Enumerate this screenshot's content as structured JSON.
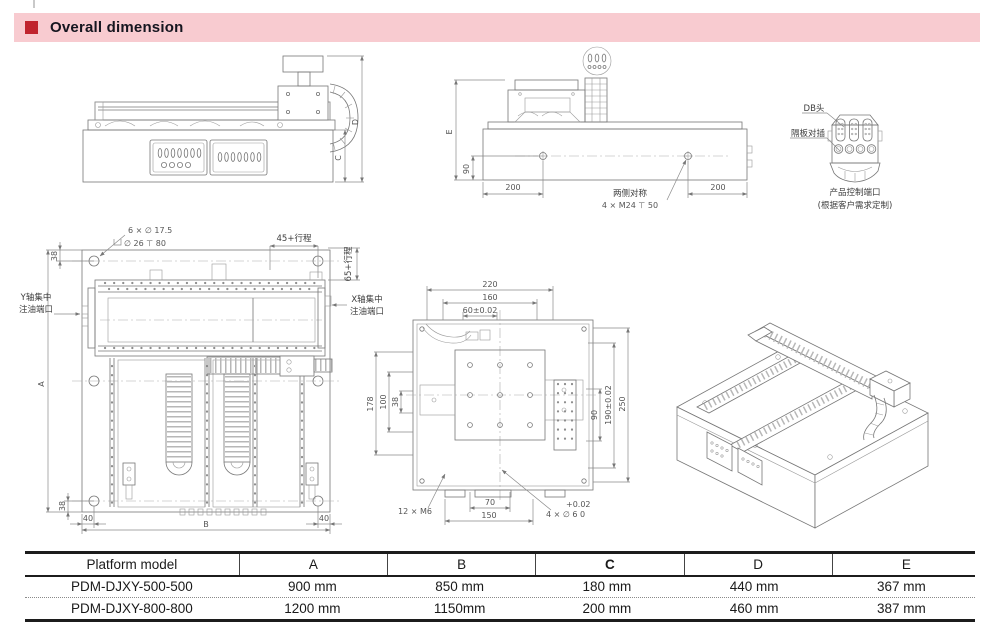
{
  "header": {
    "title": "Overall dimension",
    "band_color": "#f8cbd0",
    "accent_color": "#c0242e",
    "text_color": "#15151f"
  },
  "side_view": {
    "dim_c": "C",
    "dim_d": "D"
  },
  "end_view": {
    "dim_e": "E",
    "dim_90": "90",
    "dim_200_left": "200",
    "dim_200_right": "200",
    "note_symmetry": "两侧对称",
    "note_holes": "4 × M24 ⊤ 50"
  },
  "connector_detail": {
    "label_db": "DB头",
    "label_partition": "隔板对插",
    "caption_1": "产品控制端口",
    "caption_2": "(根据客户需求定制)"
  },
  "plan_view": {
    "callout_holes": "6 × ∅ 17.5",
    "callout_counterbore": "∅ 26 ⊤ 80",
    "dim_38_top": "38",
    "dim_38_bottom": "38",
    "dim_40_left": "40",
    "dim_40_right": "40",
    "dim_a": "A",
    "dim_b": "B",
    "dim_x_stroke": "45+行程",
    "dim_y_stroke": "65+行程",
    "label_y_oil_1": "Y轴集中",
    "label_y_oil_2": "注油端口",
    "label_x_oil_1": "X轴集中",
    "label_x_oil_2": "注油端口"
  },
  "plate_view": {
    "dim_220": "220",
    "dim_160": "160",
    "dim_60": "60±0.02",
    "dim_178": "178",
    "dim_100": "100",
    "dim_38": "38",
    "dim_90": "90",
    "dim_190": "190±0.02",
    "dim_250": "250",
    "dim_70": "70",
    "dim_150": "150",
    "callout_m6": "12 × M6",
    "callout_tol": "+0.02",
    "callout_holes": "4 × ∅ 6  0"
  },
  "table": {
    "headers": [
      "Platform model",
      "A",
      "B",
      "C",
      "D",
      "E"
    ],
    "rows": [
      [
        "PDM-DJXY-500-500",
        "900 mm",
        "850 mm",
        "180 mm",
        "440 mm",
        "367 mm"
      ],
      [
        "PDM-DJXY-800-800",
        "1200 mm",
        "1150mm",
        "200 mm",
        "460 mm",
        "387 mm"
      ]
    ]
  }
}
